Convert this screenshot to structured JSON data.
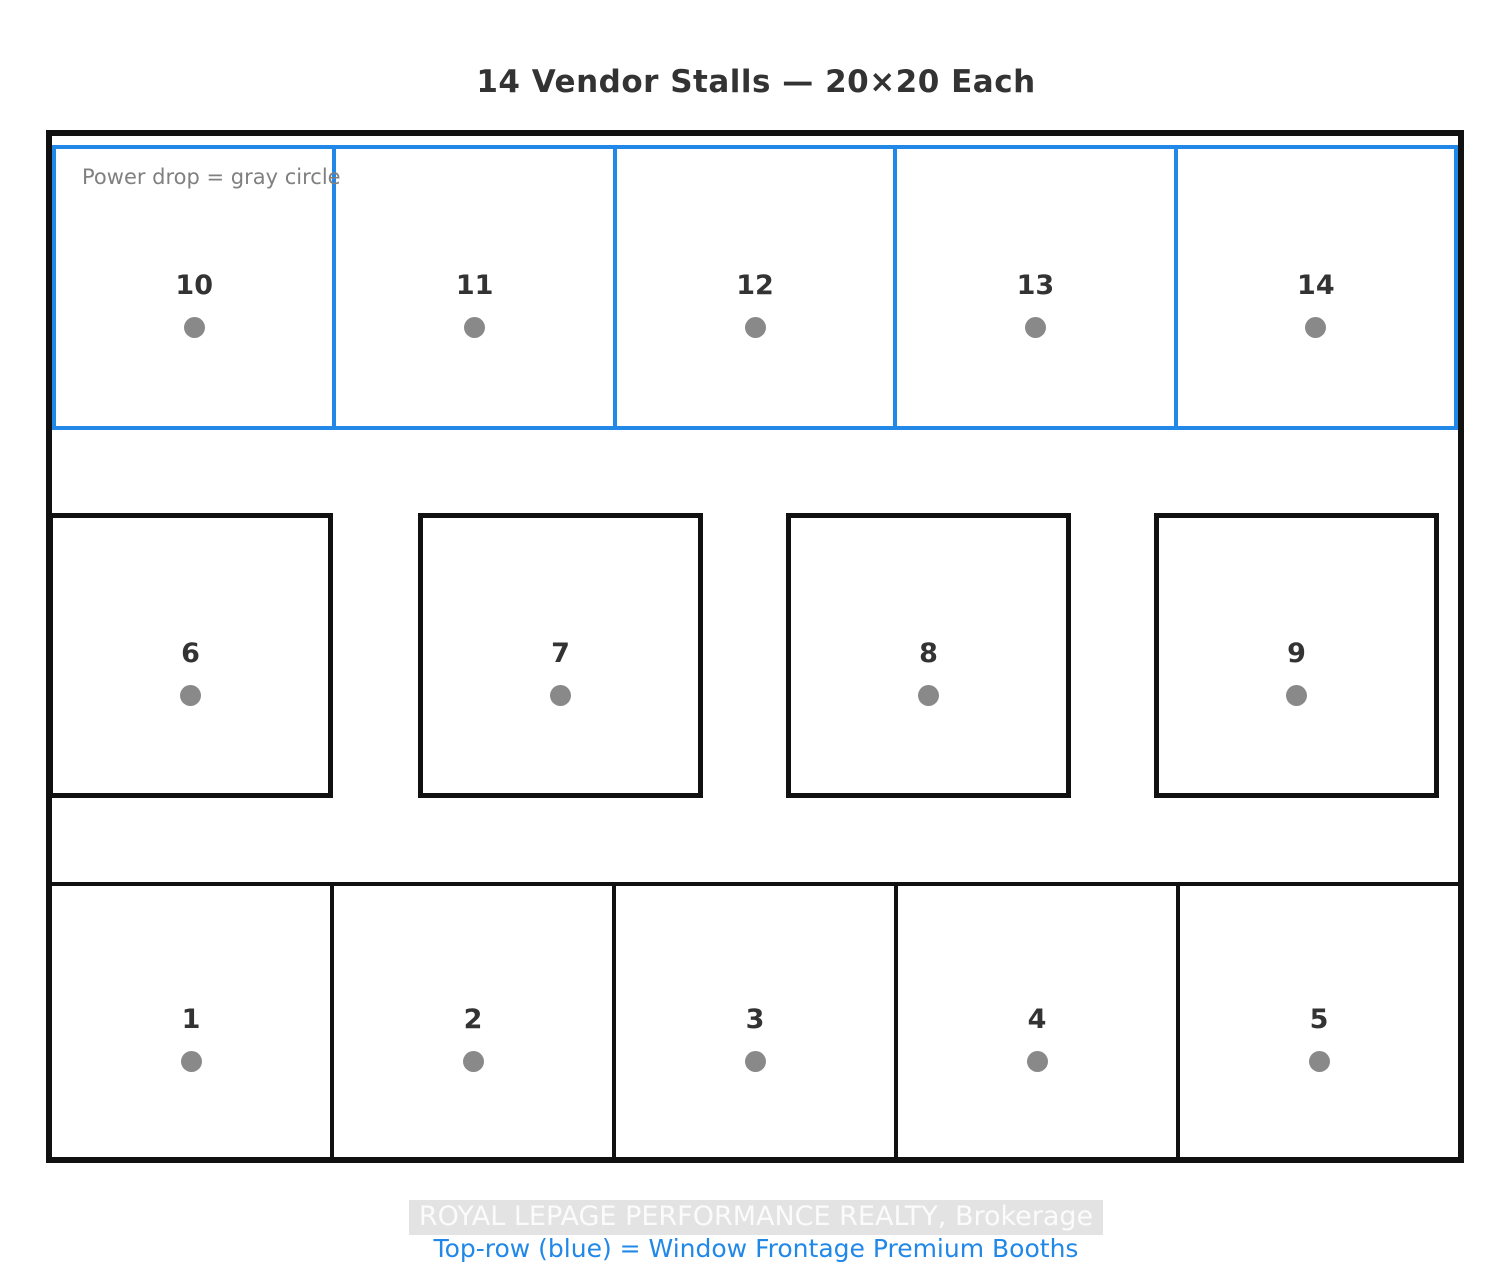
{
  "title": "14 Vendor Stalls — 20×20 Each",
  "legend": {
    "power_note": "Power drop = gray circle"
  },
  "stalls": {
    "top": [
      {
        "label": "10"
      },
      {
        "label": "11"
      },
      {
        "label": "12"
      },
      {
        "label": "13"
      },
      {
        "label": "14"
      }
    ],
    "middle": [
      {
        "label": "6"
      },
      {
        "label": "7"
      },
      {
        "label": "8"
      },
      {
        "label": "9"
      }
    ],
    "bottom": [
      {
        "label": "1"
      },
      {
        "label": "2"
      },
      {
        "label": "3"
      },
      {
        "label": "4"
      },
      {
        "label": "5"
      }
    ]
  },
  "footer": {
    "watermark": "ROYAL LEPAGE PERFORMANCE REALTY, Brokerage",
    "premium_note": "Top-row (blue) = Window Frontage Premium Booths"
  },
  "colors": {
    "premium_border": "#2288e8",
    "wall": "#111111",
    "power_dot": "#898989",
    "stall_number": "#333333",
    "note_text": "#808080",
    "watermark_bg": "#e3e3e3",
    "watermark_text": "#fbfbfb"
  }
}
